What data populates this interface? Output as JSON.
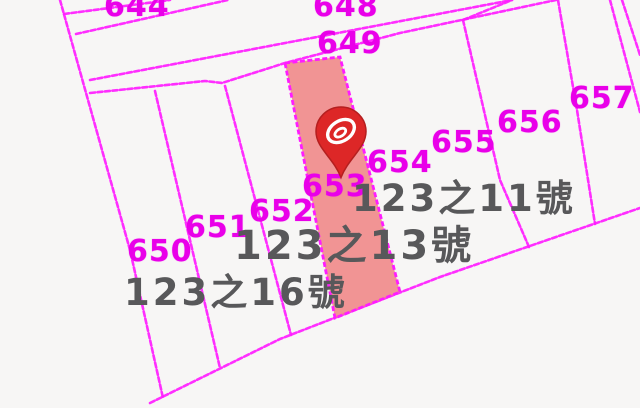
{
  "map": {
    "type": "cadastral-parcel-map",
    "background_color": "#f7f6f5",
    "line_color": "#ff1cff",
    "parcel_label_color": "#e900e9",
    "address_label_color": "#58585a",
    "highlight_fill": "#f08282",
    "highlighted_parcel": "653",
    "marker_color": "#dd2727"
  },
  "parcels": [
    {
      "label": "644"
    },
    {
      "label": "648"
    },
    {
      "label": "649"
    },
    {
      "label": "650"
    },
    {
      "label": "651"
    },
    {
      "label": "652"
    },
    {
      "label": "653"
    },
    {
      "label": "654"
    },
    {
      "label": "655"
    },
    {
      "label": "656"
    },
    {
      "label": "657"
    }
  ],
  "addresses": [
    {
      "label": "123之11號"
    },
    {
      "label": "123之13號"
    },
    {
      "label": "123之16號"
    }
  ]
}
